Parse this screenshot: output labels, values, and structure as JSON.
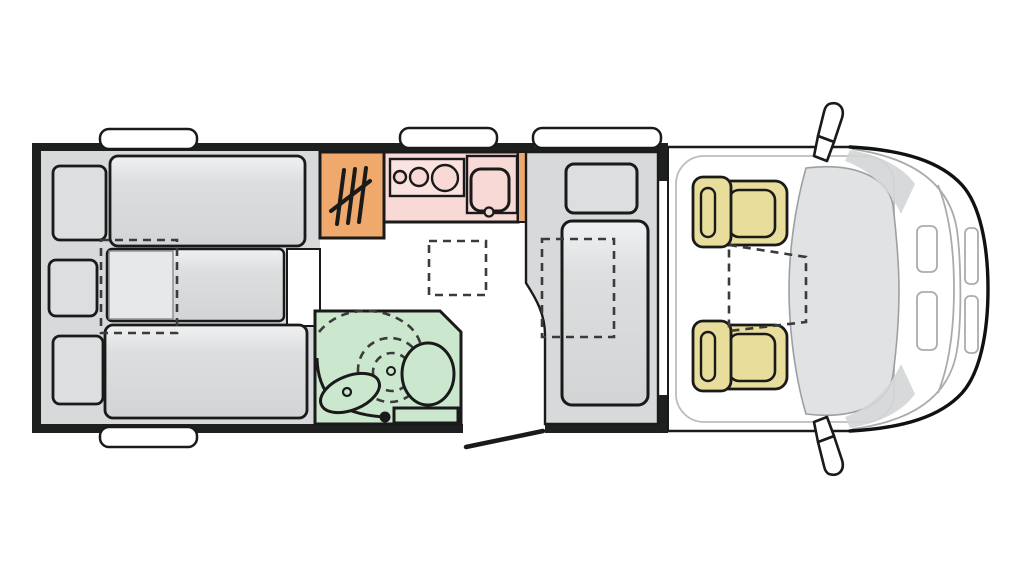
{
  "diagram": {
    "type": "motorhome-floorplan-top-view",
    "orientation": "cab-on-right",
    "zones": {
      "bedroom": {
        "name": "rear-bedroom",
        "beds": 3,
        "pillows": 3,
        "bed_extension_dashed": true
      },
      "kitchen": {
        "name": "kitchen-block",
        "hob_burners": 3,
        "sink_bowls": 1,
        "heater_unit": true
      },
      "bathroom": {
        "name": "washroom",
        "toilet": true,
        "washbasin": true,
        "swivel_wall_dashed": true
      },
      "lounge": {
        "name": "side-bench",
        "headrests": 1,
        "table_dashed": true
      },
      "cab": {
        "name": "driver-cab",
        "swivel_seats": 2,
        "mirrors": 2,
        "table_dashed": true
      }
    },
    "windows_total": 4,
    "entry_door_open": true,
    "walkway_table_dashed": true
  },
  "colors": {
    "wall_black": "#1e1f1f",
    "line_black": "#1a1a1a",
    "panel_gray": "#d7d9da",
    "pillow_gray": "#dcdee0",
    "cushion_light": "#e7e8e9",
    "cabinet_orange": "#f0a96d",
    "kitchen_pink": "#f8d9d5",
    "hob_pink": "#fae3e0",
    "bath_green": "#cbe8cf",
    "seat_khaki": "#e8dd9b",
    "windshield_gray": "#e0e2e3",
    "pillar_gray": "#d3d5d6",
    "detail_gray": "#a9acaf",
    "floor_white": "#ffffff"
  }
}
